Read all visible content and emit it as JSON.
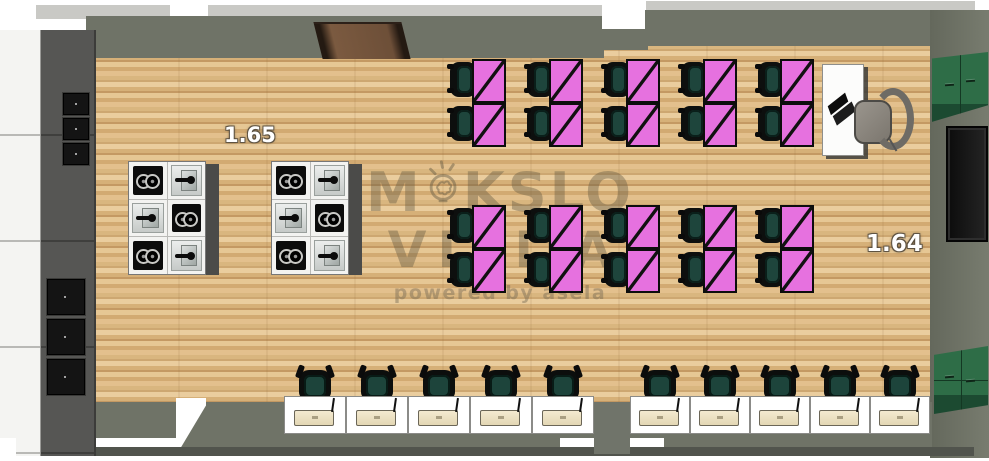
{
  "scene": {
    "type": "3d-classroom-floor-plan-render",
    "room_labels": [
      {
        "id": "room-left",
        "text": "1.65"
      },
      {
        "id": "room-right",
        "text": "1.64"
      }
    ],
    "watermark": {
      "word1_prefix": "M",
      "word1_suffix": "KSLO",
      "word2": "VIZIJA",
      "tagline": "powered by asela",
      "logo_icon": "lightbulb-brain-icon"
    },
    "furniture": {
      "kitchen_islands": {
        "count": 2,
        "unit_pattern": [
          "cooktop",
          "sink",
          "sink",
          "cooktop",
          "cooktop",
          "sink"
        ]
      },
      "student_desk_rows": [
        {
          "pairs": 5
        },
        {
          "pairs": 5
        }
      ],
      "computer_station_groups": [
        {
          "stations": 5
        },
        {
          "stations": 5
        }
      ],
      "wall_ovens": {
        "upper": 3,
        "lower": 3
      },
      "green_wall_cabinets": 2,
      "teacher_desk_items": [
        "laptop"
      ],
      "doors": {
        "top_wood_door": 1,
        "right_dark_door": 1
      }
    },
    "colors": {
      "floor_wood": "#ddb987",
      "wall": "#6f7367",
      "desk_pink": "#e671df",
      "chair_green": "#1e453c",
      "cabinet_green": "#2e6d47",
      "door_wood": "#6d4f38",
      "laptop_cream": "#ece1c4",
      "outline_dark": "#111111"
    }
  }
}
